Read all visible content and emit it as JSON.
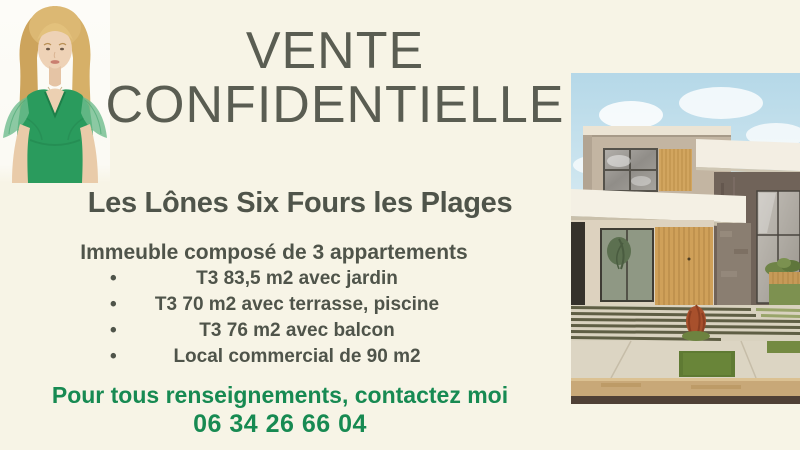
{
  "flyer": {
    "title": {
      "line1": "VENTE",
      "line2": "CONFIDENTIELLE"
    },
    "location_heading": "Les Lônes Six Fours les Plages",
    "description": {
      "intro": "Immeuble composé de 3 appartements",
      "bullet_char": "•",
      "bullets": [
        "T3 83,5 m2 avec jardin",
        "T3 70 m2 avec terrasse, piscine",
        "T3 76 m2 avec balcon",
        "Local commercial de 90 m2"
      ]
    },
    "contact": {
      "cta": "Pour tous renseignements, contactez moi",
      "phone": "06 34 26 66 04"
    },
    "colors": {
      "background": "#f7f4e6",
      "title_gray": "#5a5d52",
      "text_dark": "#4f544a",
      "accent_green": "#178a52"
    },
    "images": {
      "agent_photo": "portrait-of-agent-in-green-dress",
      "house_photo": "modern-house-exterior-with-striped-driveway"
    }
  }
}
